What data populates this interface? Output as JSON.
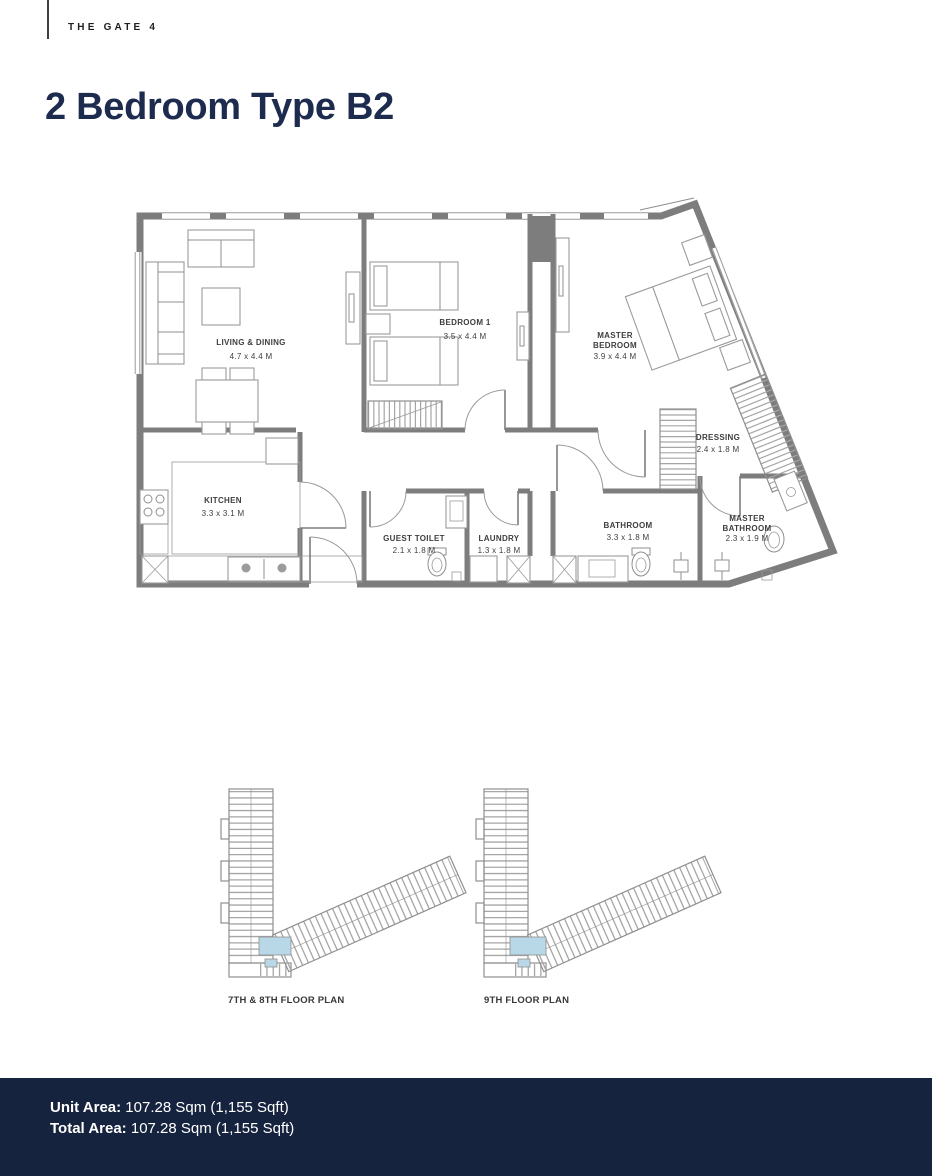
{
  "page": {
    "brand": "THE GATE 4",
    "title": "2 Bedroom Type B2"
  },
  "floor_plan": {
    "rooms": [
      {
        "name": "LIVING & DINING",
        "lines": [
          "LIVING & DINING"
        ],
        "dims": "4.7 x 4.4 M"
      },
      {
        "name": "BEDROOM 1",
        "lines": [
          "BEDROOM 1"
        ],
        "dims": "3.5 x 4.4 M"
      },
      {
        "name": "MASTER BEDROOM",
        "lines": [
          "MASTER",
          "BEDROOM"
        ],
        "dims": "3.9 x 4.4 M"
      },
      {
        "name": "KITCHEN",
        "lines": [
          "KITCHEN"
        ],
        "dims": "3.3 x 3.1 M"
      },
      {
        "name": "GUEST TOILET",
        "lines": [
          "GUEST TOILET"
        ],
        "dims": "2.1 x 1.8 M"
      },
      {
        "name": "LAUNDRY",
        "lines": [
          "LAUNDRY"
        ],
        "dims": "1.3 x 1.8 M"
      },
      {
        "name": "BATHROOM",
        "lines": [
          "BATHROOM"
        ],
        "dims": "3.3 x 1.8 M"
      },
      {
        "name": "MASTER BATHROOM",
        "lines": [
          "MASTER",
          "BATHROOM"
        ],
        "dims": "2.3 x 1.9 M"
      },
      {
        "name": "DRESSING",
        "lines": [
          "DRESSING"
        ],
        "dims": "2.4 x 1.8 M"
      }
    ]
  },
  "key_plans": [
    {
      "label": "7TH & 8TH FLOOR PLAN"
    },
    {
      "label": "9TH FLOOR PLAN"
    }
  ],
  "footer": {
    "unit_area": {
      "label": "Unit Area:",
      "value": "107.28 Sqm (1,155 Sqft)"
    },
    "total_area": {
      "label": "Total Area:",
      "value": "107.28 Sqm (1,155 Sqft)"
    }
  },
  "colors": {
    "title_navy": "#1d2b4f",
    "footer_navy": "#16233e",
    "wall_gray": "#7d7d7d",
    "key_plan_highlight": "#b8d8e8",
    "label_gray": "#3e3e3e"
  }
}
